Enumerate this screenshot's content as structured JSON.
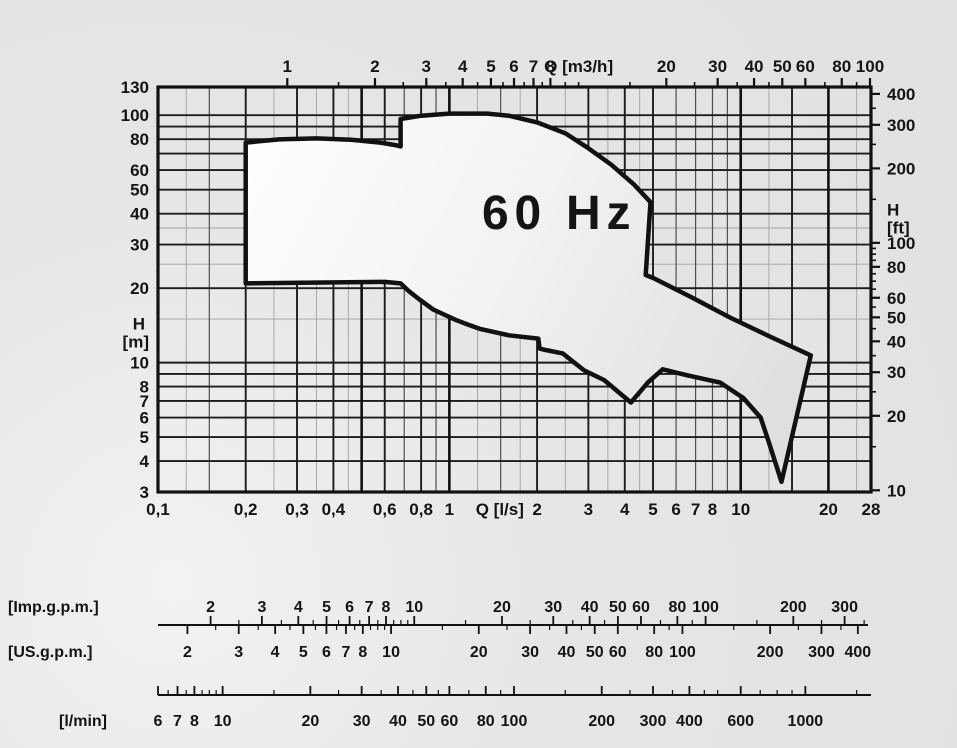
{
  "page": {
    "background": "#e3e3e3"
  },
  "colors": {
    "ink": "#141414",
    "frame": "#111111",
    "grid_dark": "#1c1c1c",
    "grid_mid": "#4f4f4f",
    "grid_light": "#a2a2a2",
    "envelope_stroke": "#111111",
    "envelope_fill_top": "#ffffff",
    "envelope_fill_mid": "#f2f2f2",
    "envelope_fill_bottom": "#dcdcdc"
  },
  "chart_data": {
    "type": "area",
    "title": "60 Hz",
    "description": "Pump performance range envelope, head H versus flow Q, log-log scales",
    "x_scale": "log",
    "y_scale": "log",
    "x_range_ls": [
      0.1,
      28
    ],
    "y_range_m": [
      3,
      130
    ],
    "axes": {
      "top": {
        "label": "Q [m3/h]",
        "units_per_ls": 3.6,
        "major_ticks": [
          1,
          2,
          3,
          4,
          5,
          6,
          7,
          8,
          20,
          30,
          40,
          50,
          60,
          80,
          100
        ],
        "minor_ticks": [
          1.5,
          2.5,
          3.5,
          4.5,
          5.5,
          6.5,
          7.5,
          9,
          10,
          15,
          25,
          35,
          45,
          70,
          90
        ],
        "unit_label_at": 10
      },
      "bottom": {
        "label": "Q [l/s]",
        "tick_labels": [
          "0,1",
          "0,2",
          "0,3",
          "0,4",
          "0,6",
          "0,8",
          "1",
          "2",
          "3",
          "4",
          "5",
          "6",
          "7",
          "8",
          "10",
          "20",
          "28"
        ],
        "tick_values": [
          0.1,
          0.2,
          0.3,
          0.4,
          0.6,
          0.8,
          1,
          2,
          3,
          4,
          5,
          6,
          7,
          8,
          10,
          20,
          28
        ],
        "unit_label_at": 1.49
      },
      "left": {
        "label_lines": [
          "H",
          "[m]"
        ],
        "tick_values": [
          130,
          100,
          80,
          60,
          50,
          40,
          30,
          20,
          10,
          8,
          7,
          6,
          5,
          4,
          3
        ],
        "unit_between": [
          20,
          10
        ]
      },
      "right": {
        "label_lines": [
          "H",
          "[ft]"
        ],
        "ft_per_m": 3.28084,
        "major_ticks": [
          400,
          300,
          200,
          100,
          80,
          60,
          50,
          40,
          30,
          20,
          10
        ],
        "minor_ticks": [
          350,
          250,
          150,
          95,
          90,
          85,
          75,
          70,
          65,
          55,
          45,
          35,
          25,
          15
        ],
        "unit_label_at_ft": 150
      }
    },
    "grid": {
      "v_thick": [
        0.5,
        1,
        10,
        20
      ],
      "v_dark": [
        0.2,
        0.3,
        0.4,
        0.6,
        0.8,
        2,
        3,
        4,
        5,
        15
      ],
      "v_mid": [
        0.15,
        0.7,
        0.9,
        1.5,
        6,
        7,
        8,
        9
      ],
      "v_light": [
        0.125,
        0.25,
        0.35,
        0.45,
        1.25,
        1.75,
        2.5,
        3.5,
        4.5,
        12.5,
        25
      ],
      "h_dark": [
        100,
        90,
        80,
        70,
        60,
        50,
        40,
        30,
        20,
        10,
        9,
        8,
        7,
        6,
        5,
        4
      ],
      "h_light": [
        35,
        25,
        15
      ]
    },
    "envelope_ls_m": [
      [
        0.2,
        20.9
      ],
      [
        0.2,
        77.5
      ],
      [
        0.26,
        79.8
      ],
      [
        0.35,
        80.6
      ],
      [
        0.46,
        79.6
      ],
      [
        0.58,
        77.5
      ],
      [
        0.66,
        75.5
      ],
      [
        0.68,
        74.8
      ],
      [
        0.68,
        96.5
      ],
      [
        0.8,
        99.5
      ],
      [
        1.0,
        101.5
      ],
      [
        1.35,
        101.5
      ],
      [
        1.6,
        99.5
      ],
      [
        2.0,
        93.5
      ],
      [
        2.5,
        84.5
      ],
      [
        3.0,
        73.5
      ],
      [
        3.6,
        63
      ],
      [
        4.3,
        52.5
      ],
      [
        4.9,
        44.5
      ],
      [
        4.72,
        22.6
      ],
      [
        5.0,
        22.0
      ],
      [
        6.7,
        18.5
      ],
      [
        9.2,
        15.2
      ],
      [
        12.5,
        12.8
      ],
      [
        17.4,
        10.7
      ],
      [
        13.8,
        3.3
      ],
      [
        12.4,
        4.9
      ],
      [
        11.7,
        6.0
      ],
      [
        10.2,
        7.2
      ],
      [
        8.5,
        8.3
      ],
      [
        6.5,
        8.9
      ],
      [
        5.4,
        9.4
      ],
      [
        4.8,
        8.3
      ],
      [
        4.2,
        6.9
      ],
      [
        3.4,
        8.5
      ],
      [
        2.9,
        9.3
      ],
      [
        2.45,
        10.9
      ],
      [
        2.1,
        11.3
      ],
      [
        2.04,
        11.4
      ],
      [
        2.02,
        12.5
      ],
      [
        1.6,
        12.9
      ],
      [
        1.27,
        13.7
      ],
      [
        1.15,
        14.3
      ],
      [
        1.05,
        14.9
      ],
      [
        0.88,
        16.4
      ],
      [
        0.79,
        18.0
      ],
      [
        0.72,
        19.6
      ],
      [
        0.68,
        20.9
      ],
      [
        0.6,
        21.2
      ]
    ],
    "rulers": {
      "gpm": {
        "imp": {
          "label": "[Imp.g.p.m.]",
          "units_per_ls": 13.198,
          "labeled": [
            2,
            3,
            4,
            5,
            6,
            7,
            8,
            10,
            20,
            30,
            40,
            50,
            60,
            80,
            100,
            200,
            300
          ],
          "minor": [
            2.5,
            3.5,
            4.5,
            5.5,
            6.5,
            7.5,
            8.5,
            9,
            9.5,
            15,
            25,
            35,
            45,
            70,
            90,
            150,
            250,
            350
          ]
        },
        "us": {
          "label": "[US.g.p.m.]",
          "units_per_ls": 15.8503,
          "labeled": [
            2,
            3,
            4,
            5,
            6,
            7,
            8,
            10,
            20,
            30,
            40,
            50,
            60,
            80,
            100,
            200,
            300,
            400
          ],
          "minor": [
            2.5,
            3.5,
            4.5,
            5.5,
            6.5,
            7.5,
            8.5,
            9,
            9.5,
            15,
            25,
            35,
            45,
            70,
            90,
            150,
            250,
            350
          ]
        }
      },
      "lmin": {
        "label": "[l/min]",
        "units_per_ls": 60,
        "labeled": [
          6,
          7,
          8,
          10,
          20,
          30,
          40,
          50,
          60,
          80,
          100,
          200,
          300,
          400,
          600,
          1000
        ],
        "minor": [
          6.5,
          7.5,
          8.5,
          9,
          9.5,
          15,
          25,
          35,
          45,
          55,
          70,
          90,
          150,
          250,
          350,
          450,
          500,
          700,
          800,
          900,
          1500
        ]
      }
    }
  }
}
